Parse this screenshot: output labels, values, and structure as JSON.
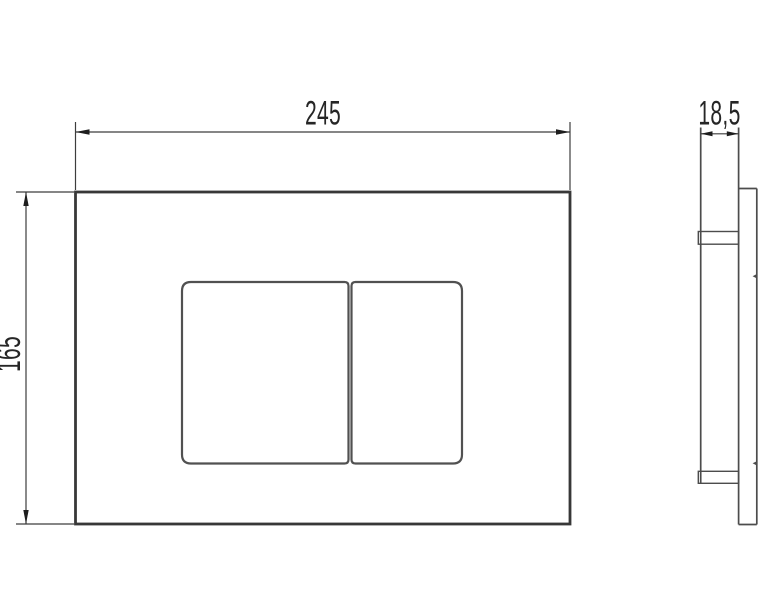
{
  "drawing_type": "flush-plate-dimension-drawing",
  "labels": {
    "width": "245",
    "height": "165",
    "depth": "18,5"
  },
  "colors": {
    "background": "#ffffff",
    "plate_line": "#383838",
    "button_line": "#515151",
    "side_view_line": "#4c4c4c",
    "dimension_line": "#3d3d3d",
    "arrow_fill": "#1e1e1e",
    "text": "#262626"
  }
}
